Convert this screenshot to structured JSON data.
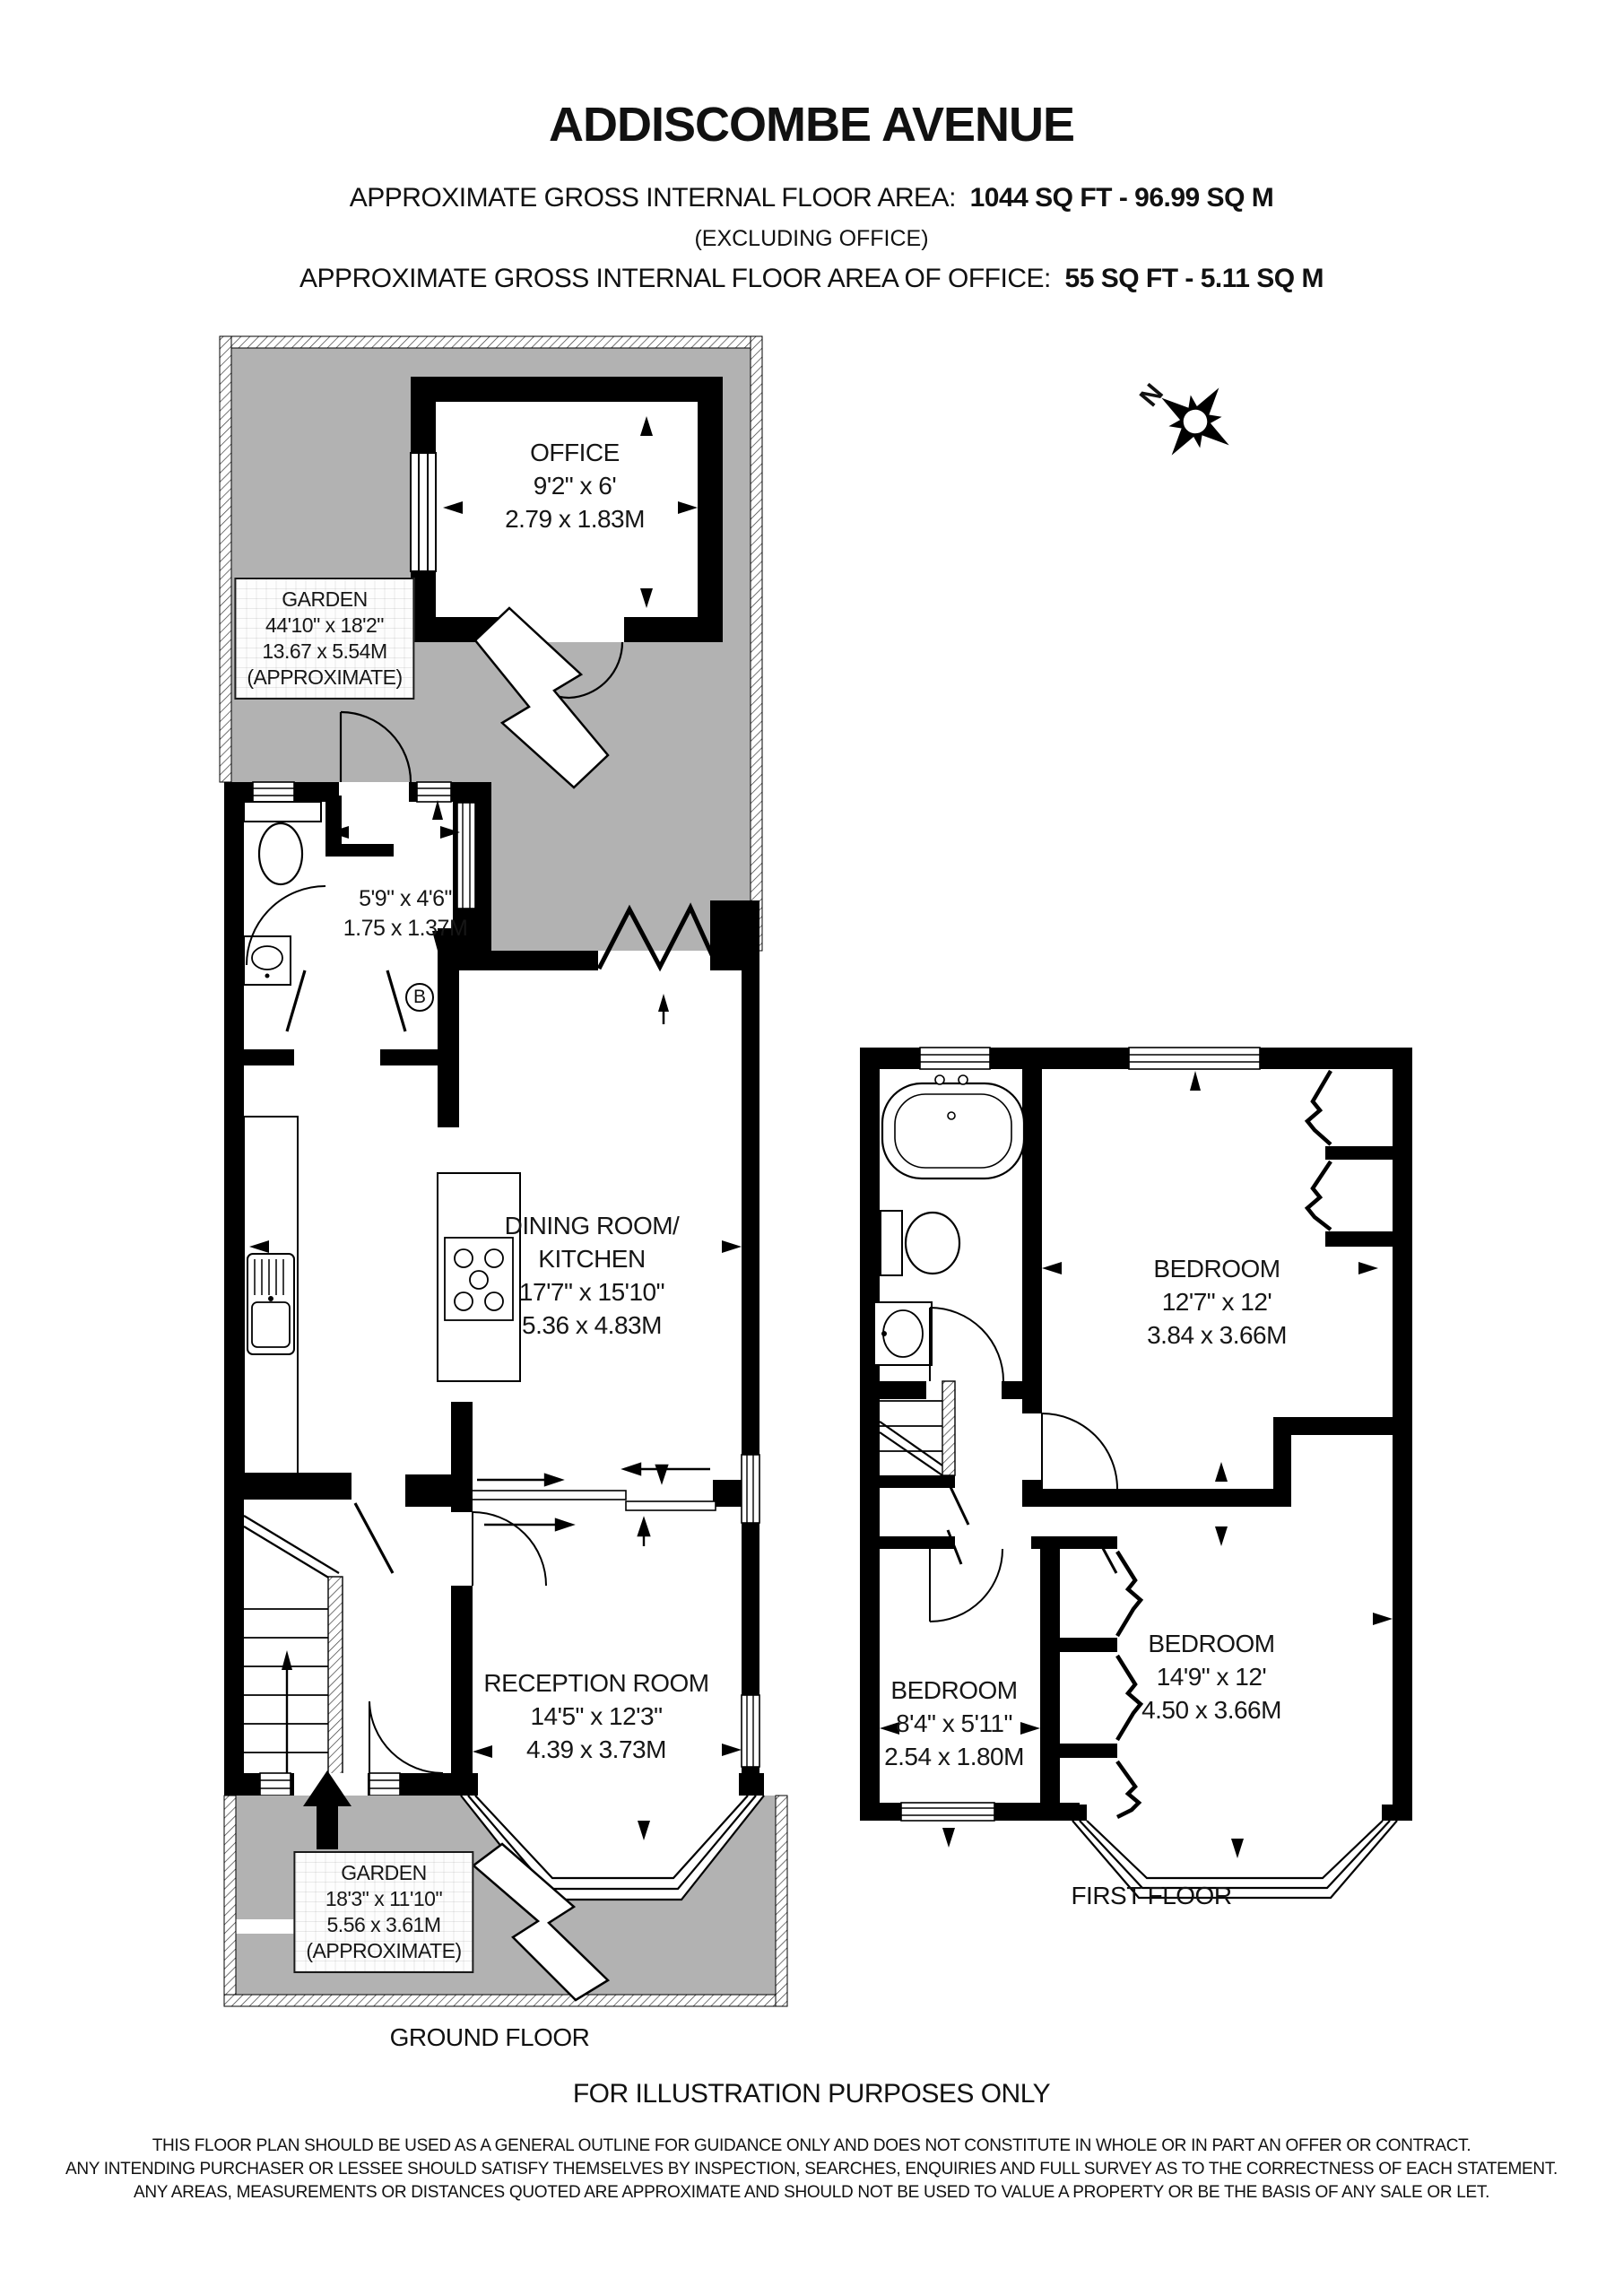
{
  "header": {
    "title": "ADDISCOMBE AVENUE",
    "area_label": "APPROXIMATE GROSS INTERNAL FLOOR AREA:",
    "area_value": "1044 SQ FT - 96.99 SQ M",
    "area_note": "(EXCLUDING OFFICE)",
    "office_area_label": "APPROXIMATE GROSS INTERNAL FLOOR AREA OF OFFICE:",
    "office_area_value": "55 SQ FT - 5.11 SQ M"
  },
  "compass": {
    "north_label": "N"
  },
  "ground_floor": {
    "floor_label": "GROUND FLOOR",
    "rear_garden": {
      "name": "GARDEN",
      "dims_imperial": "44'10\" x 18'2\"",
      "dims_metric": "13.67 x 5.54M",
      "note": "(APPROXIMATE)"
    },
    "office": {
      "name": "OFFICE",
      "dims_imperial": "9'2\" x 6'",
      "dims_metric": "2.79 x 1.83M"
    },
    "lobby": {
      "dims_imperial": "5'9\" x 4'6\"",
      "dims_metric": "1.75 x 1.37M"
    },
    "boiler_label": "B",
    "dining_kitchen": {
      "name_line1": "DINING ROOM/",
      "name_line2": "KITCHEN",
      "dims_imperial": "17'7\" x 15'10\"",
      "dims_metric": "5.36 x 4.83M"
    },
    "reception": {
      "name": "RECEPTION ROOM",
      "dims_imperial": "14'5\" x 12'3\"",
      "dims_metric": "4.39 x 3.73M"
    },
    "front_garden": {
      "name": "GARDEN",
      "dims_imperial": "18'3\" x 11'10\"",
      "dims_metric": "5.56 x 3.61M",
      "note": "(APPROXIMATE)"
    }
  },
  "first_floor": {
    "floor_label": "FIRST FLOOR",
    "bedroom_rear": {
      "name": "BEDROOM",
      "dims_imperial": "12'7\" x 12'",
      "dims_metric": "3.84 x 3.66M"
    },
    "bedroom_small": {
      "name": "BEDROOM",
      "dims_imperial": "8'4\" x 5'11\"",
      "dims_metric": "2.54 x 1.80M"
    },
    "bedroom_front": {
      "name": "BEDROOM",
      "dims_imperial": "14'9\" x 12'",
      "dims_metric": "4.50 x 3.66M"
    }
  },
  "footer": {
    "illustration_note": "FOR ILLUSTRATION PURPOSES ONLY",
    "disclaimer_line1": "THIS FLOOR PLAN SHOULD BE USED AS A GENERAL OUTLINE FOR GUIDANCE ONLY AND DOES NOT CONSTITUTE IN WHOLE OR IN PART AN OFFER OR CONTRACT.",
    "disclaimer_line2": "ANY INTENDING PURCHASER OR LESSEE SHOULD SATISFY THEMSELVES BY INSPECTION, SEARCHES, ENQUIRIES AND FULL SURVEY AS TO THE CORRECTNESS OF EACH STATEMENT.",
    "disclaimer_line3": "ANY AREAS, MEASUREMENTS OR DISTANCES QUOTED ARE APPROXIMATE AND SHOULD NOT BE USED TO VALUE A PROPERTY OR BE THE BASIS OF ANY SALE OR LET."
  },
  "colors": {
    "garden_gray": "#b2b2b2",
    "wall_black": "#000000"
  }
}
